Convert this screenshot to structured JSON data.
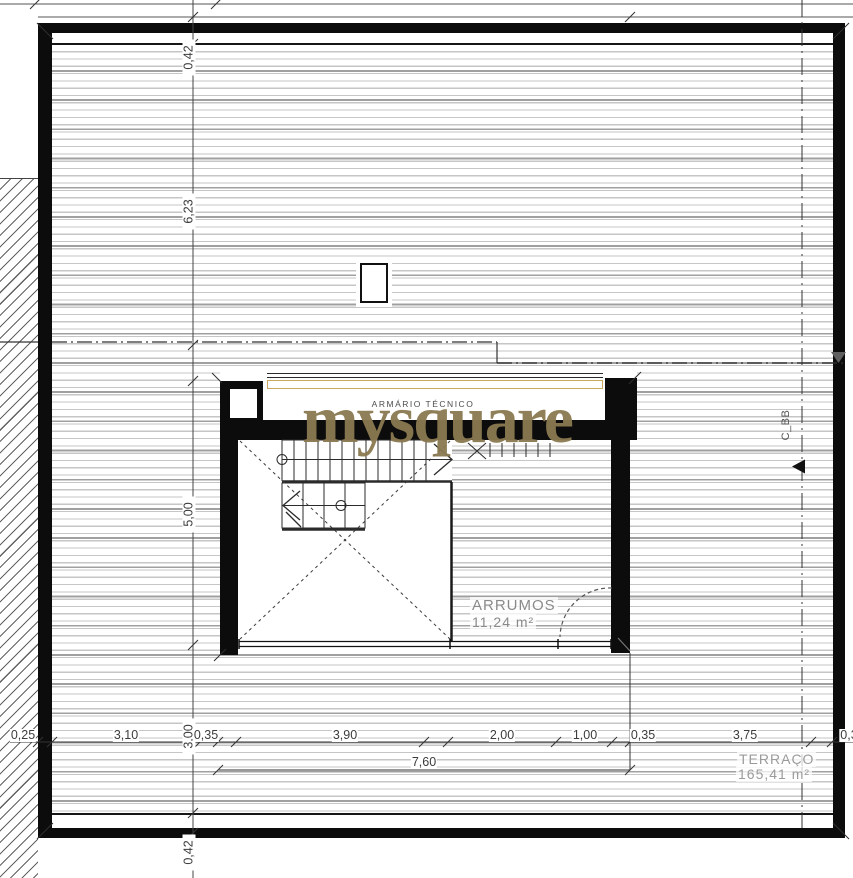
{
  "watermark": "mysquare",
  "rooms": {
    "armario_tecnico": "ARMÁRIO TÉCNICO",
    "arrumos": {
      "name": "ARRUMOS",
      "area": "11,24 m²"
    },
    "terraco": {
      "name": "TERRAÇO",
      "area": "165,41 m²"
    }
  },
  "section_marker": "C_BB",
  "dimensions": {
    "vertical": [
      "0,42",
      "6,23",
      "5,00",
      "3,00",
      "0,42"
    ],
    "bottom": [
      "0,25",
      "3,10",
      "0,35",
      "3,90",
      "2,00",
      "1,00",
      "0,35",
      "3,75",
      "0,3"
    ],
    "bottom_total": "7,60"
  },
  "colors": {
    "wall": "#0c0c0c",
    "watermark": "#8b7a51",
    "cabinet_accent": "#c9a95e",
    "hatch_line": "#c6c6c6",
    "hatch_line_dark": "#9f9f9f",
    "diagonal_hatch": "#616161",
    "dim_text": "#3c3c3c",
    "room_text": "#8f8f8f"
  },
  "icons": {
    "section_arrow_down": "triangle-down",
    "section_arrow_left": "triangle-left"
  }
}
